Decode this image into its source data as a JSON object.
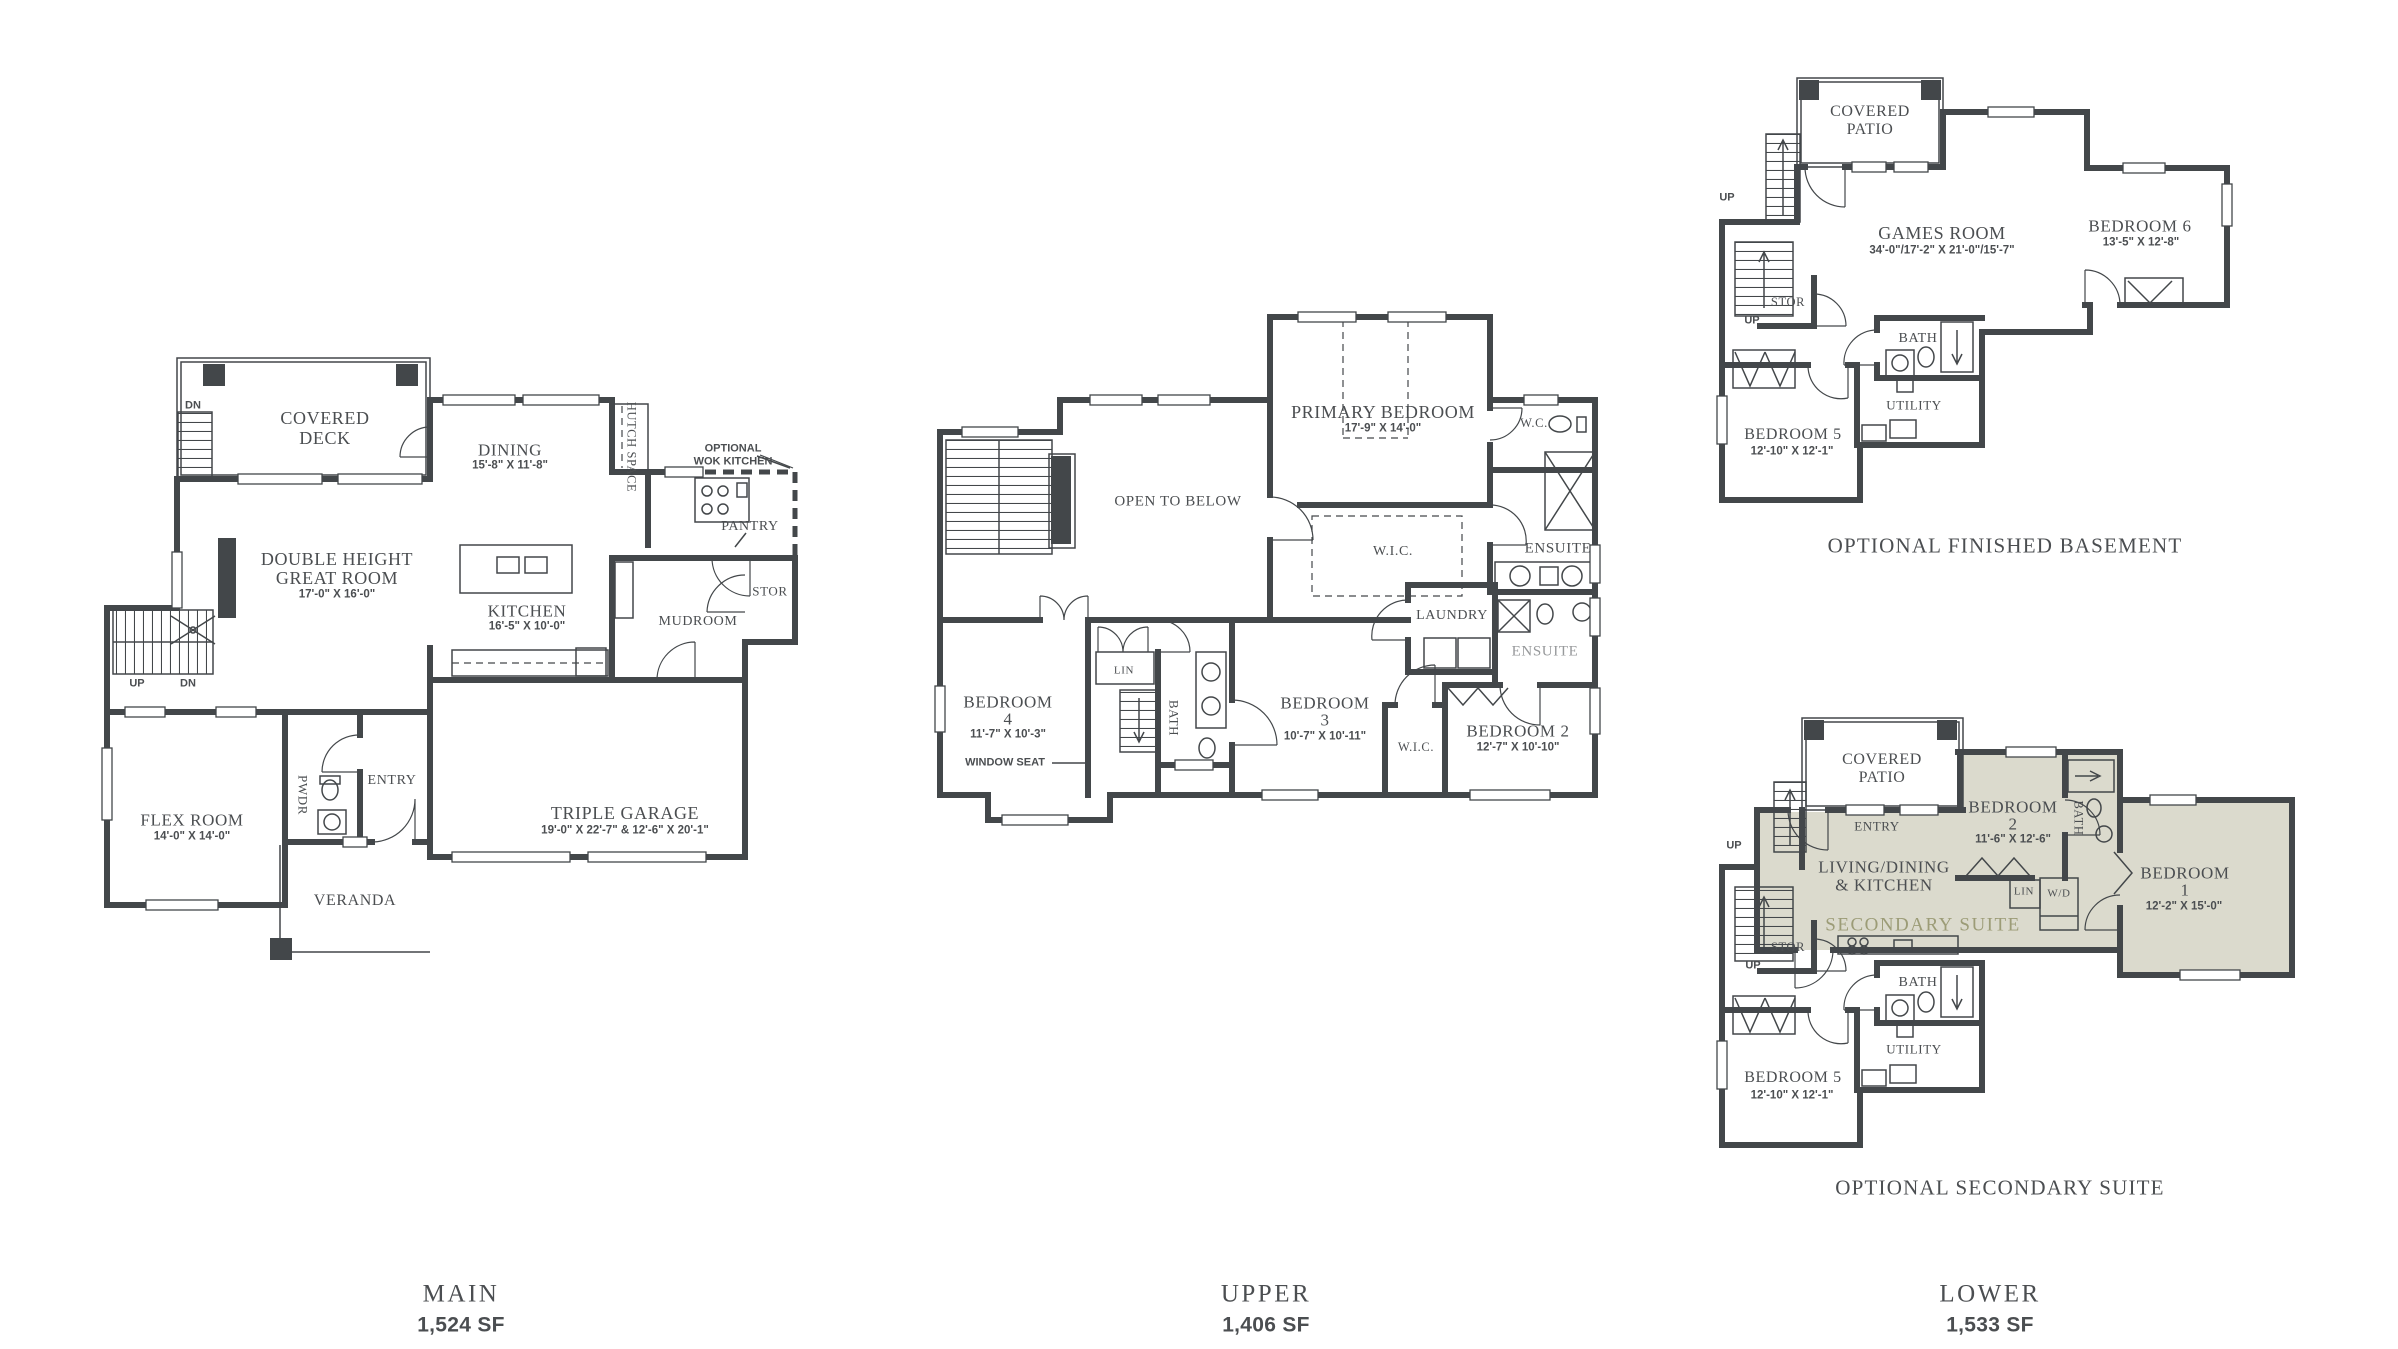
{
  "colors": {
    "wall": "#43474a",
    "text": "#4b4e51",
    "suite_fill": "#dbdacd",
    "suite_text": "#9c9c77",
    "muted": "#97999b"
  },
  "main_plan": {
    "deck_dn": "DN",
    "covered_deck_line1": "COVERED",
    "covered_deck_line2": "DECK",
    "dining": "DINING",
    "dining_dims": "15'-8\" X 11'-8\"",
    "hutch_space": "HUTCH SPACE",
    "wok_line1": "OPTIONAL",
    "wok_line2": "WOK KITCHEN",
    "pantry": "PANTRY",
    "great_room_line1": "DOUBLE HEIGHT",
    "great_room_line2": "GREAT ROOM",
    "great_room_dims": "17'-0\" X 16'-0\"",
    "kitchen": "KITCHEN",
    "kitchen_dims": "16'-5\" X 10'-0\"",
    "stor": "STOR",
    "mudroom": "MUDROOM",
    "up": "UP",
    "dn": "DN",
    "flex_room": "FLEX ROOM",
    "flex_room_dims": "14'-0\" X 14'-0\"",
    "pwdr": "PWDR",
    "entry": "ENTRY",
    "veranda": "VERANDA",
    "garage": "TRIPLE GARAGE",
    "garage_dims": "19'-0\" X 22'-7\" & 12'-6\" X 20'-1\""
  },
  "upper_plan": {
    "primary_bedroom": "PRIMARY BEDROOM",
    "primary_bedroom_dims": "17'-9\" X 14'-0\"",
    "wc": "W.C.",
    "open_to_below": "OPEN TO BELOW",
    "wic": "W.I.C.",
    "ensuite": "ENSUITE",
    "laundry": "LAUNDRY",
    "optional_ensuite": "ENSUITE",
    "bedroom4": "BEDROOM",
    "bedroom4_num": "4",
    "bedroom4_dims": "11'-7\" X 10'-3\"",
    "window_seat": "WINDOW SEAT",
    "lin": "LIN",
    "bath": "BATH",
    "bedroom3": "BEDROOM",
    "bedroom3_num": "3",
    "bedroom3_dims": "10'-7\" X 10'-11\"",
    "wic2": "W.I.C.",
    "bedroom2": "BEDROOM 2",
    "bedroom2_dims": "12'-7\" X 10'-10\""
  },
  "basement_plan": {
    "covered_patio_line1": "COVERED",
    "covered_patio_line2": "PATIO",
    "up_outer": "UP",
    "up_inner": "UP",
    "stor": "STOR",
    "games_room": "GAMES ROOM",
    "games_room_dims": "34'-0\"/17'-2\" X 21'-0\"/15'-7\"",
    "bedroom6": "BEDROOM 6",
    "bedroom6_dims": "13'-5\" X 12'-8\"",
    "bath": "BATH",
    "utility": "UTILITY",
    "bedroom5": "BEDROOM 5",
    "bedroom5_dims": "12'-10\" X 12'-1\"",
    "note": "OPTIONAL FINISHED BASEMENT"
  },
  "lower_plan": {
    "covered_patio_line1": "COVERED",
    "covered_patio_line2": "PATIO",
    "entry": "ENTRY",
    "living_line1": "LIVING/DINING",
    "living_line2": "& KITCHEN",
    "secondary_suite": "SECONDARY SUITE",
    "bedroom2": "BEDROOM",
    "bedroom2_num": "2",
    "bedroom2_dims": "11'-6\" X 12'-6\"",
    "bath_suite": "BATH",
    "lin": "LIN",
    "wd": "W/D",
    "bedroom1": "BEDROOM",
    "bedroom1_num": "1",
    "bedroom1_dims": "12'-2\" X 15'-0\"",
    "up_outer": "UP",
    "up_inner": "UP",
    "stor": "STOR",
    "bath": "BATH",
    "utility": "UTILITY",
    "bedroom5": "BEDROOM 5",
    "bedroom5_dims": "12'-10\" X 12'-1\"",
    "note": "OPTIONAL SECONDARY SUITE"
  },
  "footer": {
    "main_name": "MAIN",
    "main_area": "1,524 SF",
    "upper_name": "UPPER",
    "upper_area": "1,406 SF",
    "lower_name": "LOWER",
    "lower_area": "1,533 SF"
  }
}
